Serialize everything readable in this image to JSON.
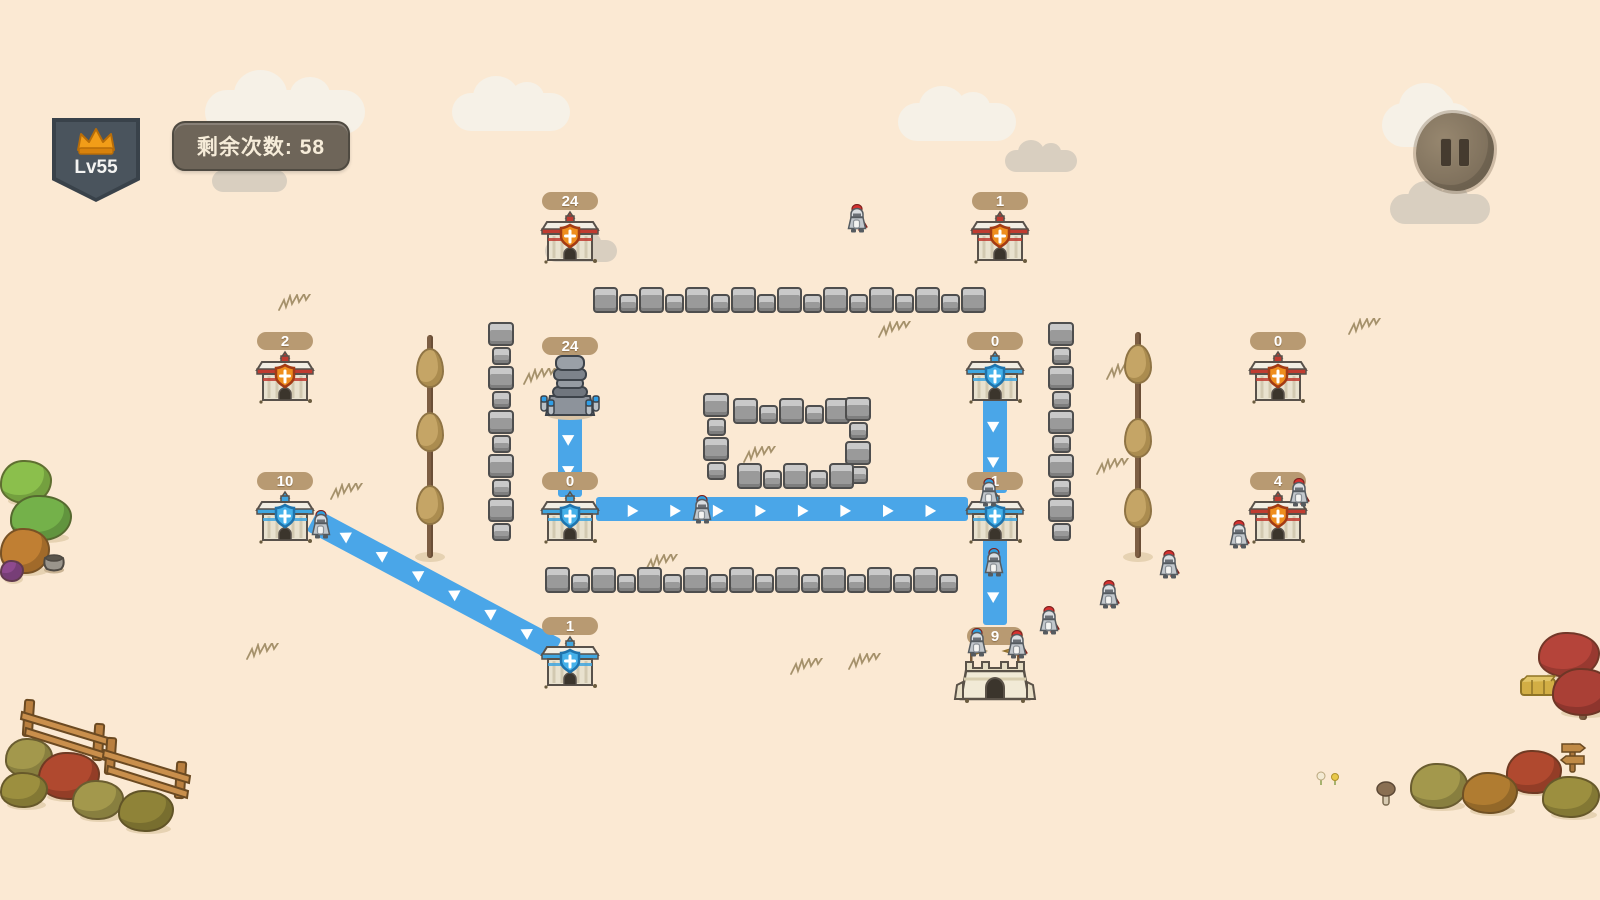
{
  "hud": {
    "level_badge": {
      "label": "Lv55",
      "icon": "crown-icon"
    },
    "counter": {
      "label": "剩余次数: 58"
    },
    "pause_button": {
      "icon": "pause-icon"
    }
  },
  "colors": {
    "background": "#fbe9d3",
    "path_blue": "#4aa6e8",
    "team_red_stripe": "#c03b30",
    "team_red_shield": "#ef8e1e",
    "team_blue": "#3fa6e0",
    "pill_tan": "#b89a72",
    "wall_gray": "#9a9a9a"
  },
  "buildings": [
    {
      "id": "b1",
      "type": "barracks",
      "team": "red",
      "value": "24",
      "x": 570,
      "y": 210
    },
    {
      "id": "b2",
      "type": "barracks",
      "team": "red",
      "value": "1",
      "x": 1000,
      "y": 210
    },
    {
      "id": "b3",
      "type": "barracks",
      "team": "red",
      "value": "2",
      "x": 285,
      "y": 350
    },
    {
      "id": "b4",
      "type": "tower",
      "team": "blue",
      "value": "24",
      "x": 570,
      "y": 352
    },
    {
      "id": "b5",
      "type": "barracks",
      "team": "blue",
      "value": "0",
      "x": 995,
      "y": 350
    },
    {
      "id": "b6",
      "type": "barracks",
      "team": "red",
      "value": "0",
      "x": 1278,
      "y": 350
    },
    {
      "id": "b7",
      "type": "barracks",
      "team": "blue",
      "value": "10",
      "x": 285,
      "y": 490
    },
    {
      "id": "b8",
      "type": "barracks",
      "team": "blue",
      "value": "0",
      "x": 570,
      "y": 490
    },
    {
      "id": "b9",
      "type": "barracks",
      "team": "blue",
      "value": "1",
      "x": 995,
      "y": 490
    },
    {
      "id": "b10",
      "type": "barracks",
      "team": "red",
      "value": "4",
      "x": 1278,
      "y": 490
    },
    {
      "id": "b11",
      "type": "barracks",
      "team": "blue",
      "value": "1",
      "x": 570,
      "y": 635
    },
    {
      "id": "b12",
      "type": "castle",
      "team": "blue",
      "value": "9",
      "x": 995,
      "y": 645
    }
  ],
  "paths": [
    {
      "x1": 570,
      "y1": 415,
      "x2": 570,
      "y2": 497
    },
    {
      "x1": 596,
      "y1": 509,
      "x2": 968,
      "y2": 509
    },
    {
      "x1": 995,
      "y1": 397,
      "x2": 995,
      "y2": 493
    },
    {
      "x1": 995,
      "y1": 538,
      "x2": 995,
      "y2": 625
    },
    {
      "x1": 556,
      "y1": 650,
      "x2": 312,
      "y2": 520
    }
  ],
  "walls": [
    {
      "orient": "h",
      "x": 593,
      "y": 298,
      "len": 392
    },
    {
      "orient": "h",
      "x": 545,
      "y": 578,
      "len": 420
    },
    {
      "orient": "v",
      "x": 501,
      "y": 322,
      "len": 224
    },
    {
      "orient": "v",
      "x": 1061,
      "y": 322,
      "len": 224
    },
    {
      "orient": "v",
      "x": 716,
      "y": 393,
      "len": 90
    },
    {
      "orient": "v",
      "x": 858,
      "y": 397,
      "len": 88
    },
    {
      "orient": "h",
      "x": 733,
      "y": 409,
      "len": 104
    },
    {
      "orient": "h",
      "x": 737,
      "y": 474,
      "len": 104
    }
  ],
  "trees": [
    {
      "x": 430,
      "top": 335,
      "bottom": 558,
      "tufts": [
        348,
        412,
        485
      ]
    },
    {
      "x": 1138,
      "top": 332,
      "bottom": 558,
      "tufts": [
        344,
        418,
        488
      ]
    }
  ],
  "soldiers": [
    {
      "team": "red",
      "x": 858,
      "y": 204
    },
    {
      "team": "red",
      "x": 1300,
      "y": 478
    },
    {
      "team": "red",
      "x": 1240,
      "y": 520
    },
    {
      "team": "red",
      "x": 1170,
      "y": 550
    },
    {
      "team": "red",
      "x": 1110,
      "y": 580
    },
    {
      "team": "red",
      "x": 1050,
      "y": 606
    },
    {
      "team": "red",
      "x": 1018,
      "y": 630
    },
    {
      "team": "blue",
      "x": 322,
      "y": 510
    },
    {
      "team": "blue",
      "x": 703,
      "y": 495
    },
    {
      "team": "blue",
      "x": 990,
      "y": 478
    },
    {
      "team": "blue",
      "x": 995,
      "y": 548
    },
    {
      "team": "blue",
      "x": 978,
      "y": 628
    }
  ],
  "decorations": [
    {
      "type": "tree-round",
      "x": 0,
      "y": 460,
      "w": 52,
      "h": 44,
      "color": "#8bbf4c"
    },
    {
      "type": "tree-round",
      "x": 10,
      "y": 495,
      "w": 62,
      "h": 46,
      "color": "#74b14a"
    },
    {
      "type": "bush",
      "x": 0,
      "y": 528,
      "w": 50,
      "h": 46,
      "color": "#c07f33"
    },
    {
      "type": "bush",
      "x": 0,
      "y": 560,
      "w": 24,
      "h": 22,
      "color": "#8e4a8e"
    },
    {
      "type": "pot",
      "x": 42,
      "y": 550,
      "w": 24,
      "h": 24
    },
    {
      "type": "fence",
      "x": 18,
      "y": 698,
      "w": 84,
      "h": 66
    },
    {
      "type": "fence",
      "x": 100,
      "y": 736,
      "w": 94,
      "h": 64
    },
    {
      "type": "bush",
      "x": 5,
      "y": 738,
      "w": 48,
      "h": 40,
      "color": "#a3984c"
    },
    {
      "type": "bush",
      "x": 38,
      "y": 752,
      "w": 62,
      "h": 48,
      "color": "#b0492f"
    },
    {
      "type": "bush",
      "x": 0,
      "y": 772,
      "w": 48,
      "h": 36,
      "color": "#9c8f3f"
    },
    {
      "type": "bush",
      "x": 72,
      "y": 780,
      "w": 52,
      "h": 40,
      "color": "#a3984c"
    },
    {
      "type": "bush",
      "x": 118,
      "y": 790,
      "w": 56,
      "h": 42,
      "color": "#8f8338"
    },
    {
      "type": "tree-round",
      "x": 1538,
      "y": 632,
      "w": 62,
      "h": 46,
      "color": "#b5443a"
    },
    {
      "type": "tree-round",
      "x": 1552,
      "y": 668,
      "w": 62,
      "h": 48,
      "color": "#aa4036"
    },
    {
      "type": "hay",
      "x": 1520,
      "y": 674,
      "w": 36,
      "h": 22
    },
    {
      "type": "bush",
      "x": 1410,
      "y": 763,
      "w": 58,
      "h": 46,
      "color": "#a3984c"
    },
    {
      "type": "bush",
      "x": 1462,
      "y": 772,
      "w": 56,
      "h": 42,
      "color": "#b07c31"
    },
    {
      "type": "bush",
      "x": 1506,
      "y": 750,
      "w": 56,
      "h": 44,
      "color": "#b0492f"
    },
    {
      "type": "bush",
      "x": 1542,
      "y": 776,
      "w": 58,
      "h": 42,
      "color": "#9c8f3f"
    },
    {
      "type": "sign",
      "x": 1558,
      "y": 740,
      "w": 30,
      "h": 34
    },
    {
      "type": "mushroom",
      "x": 1376,
      "y": 780,
      "w": 20,
      "h": 27
    },
    {
      "type": "flowers",
      "x": 1316,
      "y": 770,
      "w": 26,
      "h": 16
    }
  ],
  "grass": [
    [
      278,
      294
    ],
    [
      330,
      483
    ],
    [
      523,
      368
    ],
    [
      878,
      321
    ],
    [
      1106,
      363
    ],
    [
      1096,
      458
    ],
    [
      645,
      554
    ],
    [
      790,
      658
    ],
    [
      848,
      653
    ],
    [
      246,
      643
    ],
    [
      1348,
      318
    ],
    [
      743,
      446
    ]
  ],
  "clouds": [
    {
      "x": 205,
      "y": 90,
      "w": 160,
      "h": 44,
      "tone": "light"
    },
    {
      "x": 212,
      "y": 170,
      "w": 75,
      "h": 22,
      "tone": "dark"
    },
    {
      "x": 452,
      "y": 93,
      "w": 118,
      "h": 38,
      "tone": "light"
    },
    {
      "x": 545,
      "y": 240,
      "w": 72,
      "h": 22,
      "tone": "dark"
    },
    {
      "x": 898,
      "y": 103,
      "w": 118,
      "h": 38,
      "tone": "light"
    },
    {
      "x": 1005,
      "y": 150,
      "w": 72,
      "h": 22,
      "tone": "dark"
    },
    {
      "x": 1382,
      "y": 103,
      "w": 92,
      "h": 44,
      "tone": "light"
    },
    {
      "x": 1390,
      "y": 194,
      "w": 100,
      "h": 30,
      "tone": "dark"
    }
  ]
}
